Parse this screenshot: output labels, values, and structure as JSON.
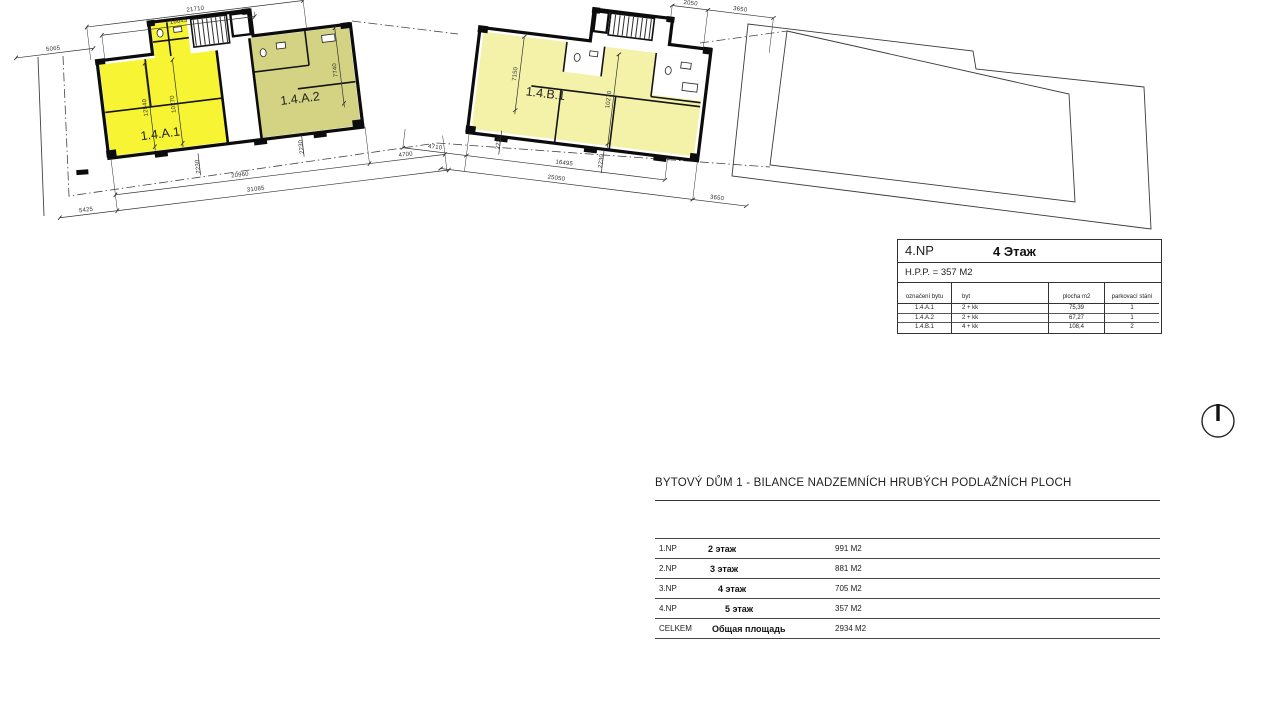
{
  "title_block": {
    "floor_code": "4.NP",
    "floor_name": "4 Этаж",
    "hpp": "H.P.P. = 357 M2",
    "columns": [
      "označení bytu",
      "byt",
      "plocha m2",
      "parkovací stání"
    ],
    "rows": [
      {
        "id": "1.4.A.1",
        "type": "2 + kk",
        "area": "75,39",
        "parking": "1"
      },
      {
        "id": "1.4.A.2",
        "type": "2 + kk",
        "area": "67,27",
        "parking": "1"
      },
      {
        "id": "1.4.B.1",
        "type": "4 + kk",
        "area": "108,4",
        "parking": "2"
      }
    ]
  },
  "summary": {
    "title": "BYTOVÝ DŮM 1 - BILANCE NADZEMNÍCH HRUBÝCH PODLAŽNÍCH PLOCH",
    "rows": [
      {
        "code": "1.NP",
        "floor": "2 этаж",
        "area": "991 M2"
      },
      {
        "code": "2.NP",
        "floor": "3 этаж",
        "area": "881 M2"
      },
      {
        "code": "3.NP",
        "floor": "4 этаж",
        "area": "705 M2"
      },
      {
        "code": "4.NP",
        "floor": "5 этаж",
        "area": "357 M2"
      },
      {
        "code": "CELKEM",
        "floor": "Общая площадь",
        "area": "2934 M2"
      }
    ]
  },
  "plans": {
    "left": {
      "apartments": [
        "1.4.A.1",
        "1.4.A.2"
      ]
    },
    "right": {
      "apartments": [
        "1.4.B.1"
      ]
    }
  },
  "dims": {
    "left": [
      {
        "t": "21710",
        "x": 208,
        "y": 6
      },
      {
        "t": "16645",
        "x": 190,
        "y": 16
      },
      {
        "t": "5065",
        "x": 62,
        "y": 28
      },
      {
        "t": "12540",
        "x": 148,
        "y": 96,
        "r": -90
      },
      {
        "t": "10270",
        "x": 176,
        "y": 96,
        "r": -90
      },
      {
        "t": "7740",
        "x": 341,
        "y": 82,
        "r": -90
      },
      {
        "t": "2230",
        "x": 193,
        "y": 161,
        "r": -90
      },
      {
        "t": "2230",
        "x": 298,
        "y": 154,
        "r": -90
      },
      {
        "t": "20960",
        "x": 232,
        "y": 176
      },
      {
        "t": "4700",
        "x": 399,
        "y": 176
      },
      {
        "t": "5425",
        "x": 75,
        "y": 192
      },
      {
        "t": "31085",
        "x": 246,
        "y": 192
      }
    ],
    "right": [
      {
        "t": "2050",
        "x": 678,
        "y": -8
      },
      {
        "t": "3650",
        "x": 728,
        "y": -8
      },
      {
        "t": "7150",
        "x": 514,
        "y": 82,
        "r": -90
      },
      {
        "t": "10270",
        "x": 610,
        "y": 96,
        "r": -90
      },
      {
        "t": "2230",
        "x": 506,
        "y": 152,
        "r": -90
      },
      {
        "t": "2230",
        "x": 610,
        "y": 158,
        "r": -90
      },
      {
        "t": "4710",
        "x": 442,
        "y": 166
      },
      {
        "t": "16495",
        "x": 572,
        "y": 166
      },
      {
        "t": "25050",
        "x": 566,
        "y": 182
      },
      {
        "t": "3650",
        "x": 728,
        "y": 182
      }
    ]
  },
  "colors": {
    "apartment_bright": "#f7f433",
    "apartment_olive": "#d3d383",
    "apartment_pale": "#f3f2a8",
    "wall": "#0c0c0c",
    "line": "#3a3a3a"
  }
}
